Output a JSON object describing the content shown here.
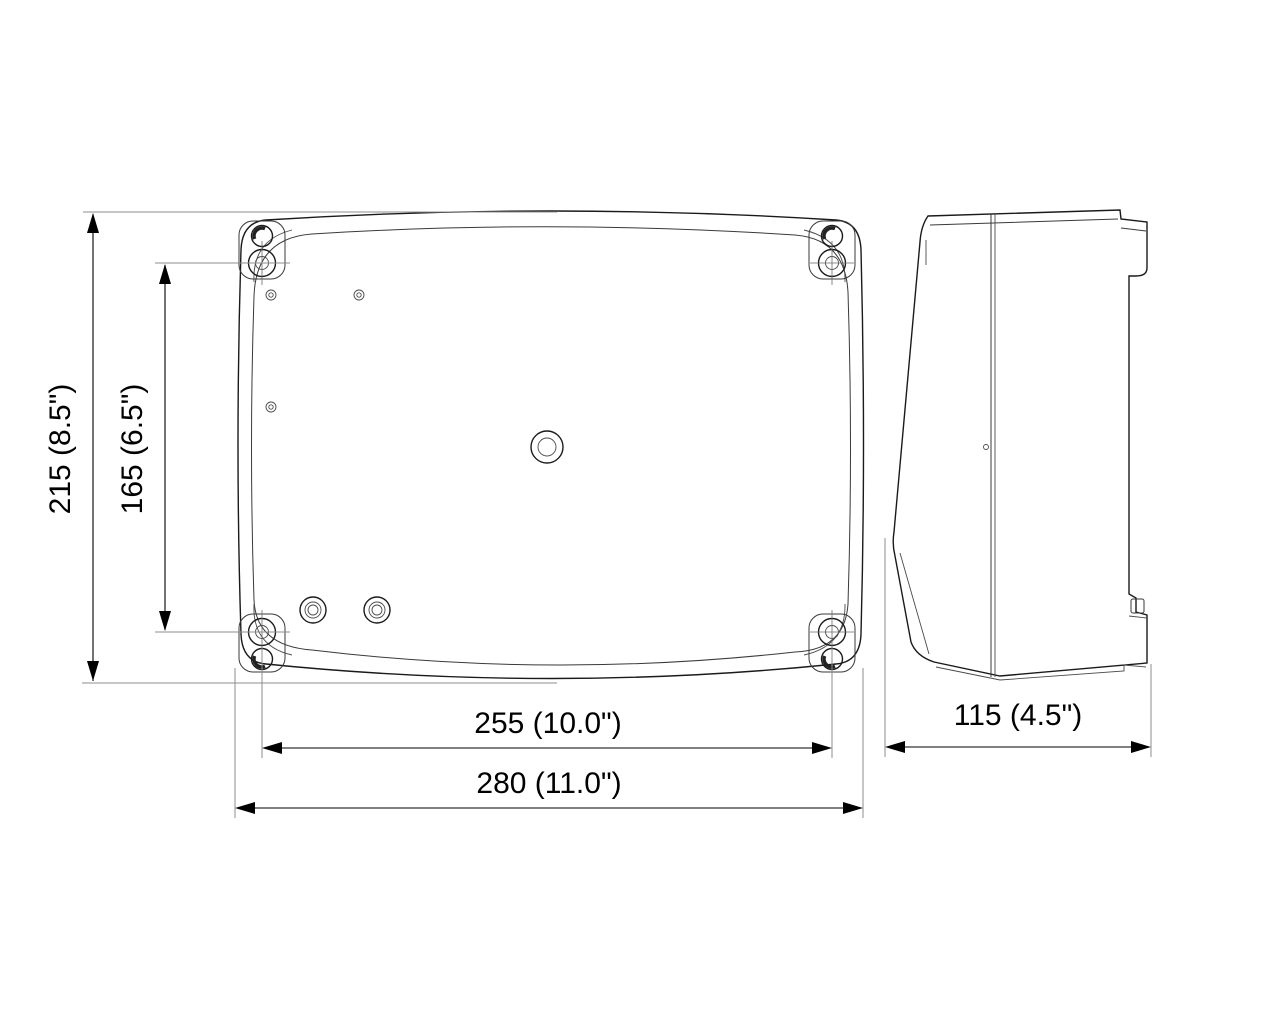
{
  "drawing": {
    "type": "technical-dimension-drawing",
    "subject": "wall-mount enclosure, front view and side view",
    "units": "mm (inches)",
    "colors": {
      "background": "#ffffff",
      "outline": "#1a1a1a",
      "dimension": "#000000",
      "extension": "#8c8c8c"
    },
    "dimensions": {
      "height_outer": "215  (8.5\")",
      "height_inner": "165  (6.5\")",
      "width_inner": "255 (10.0\")",
      "width_outer": "280 (11.0\")",
      "depth": "115 (4.5\")"
    }
  }
}
